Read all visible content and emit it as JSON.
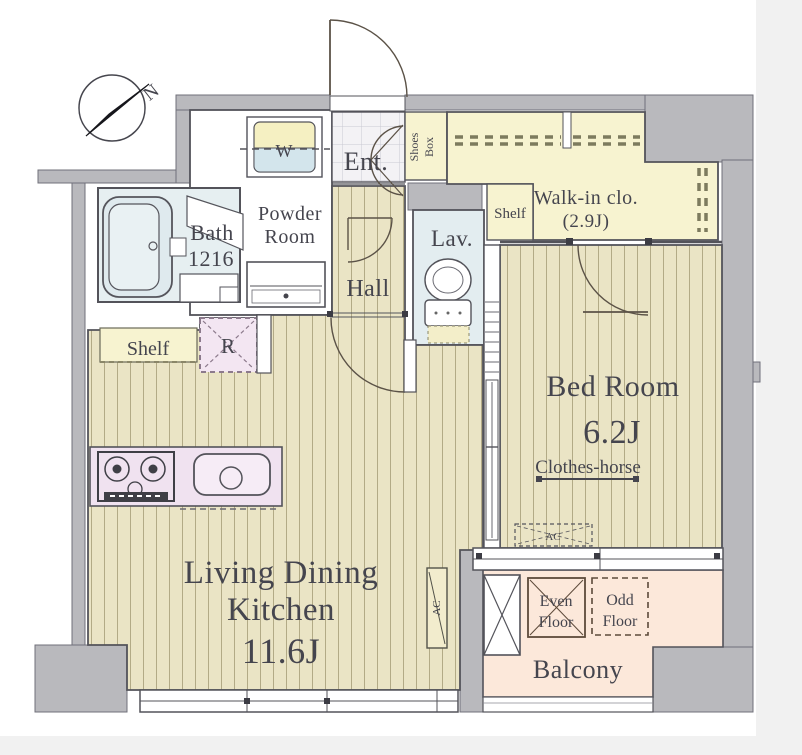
{
  "plan": {
    "compass": {
      "north": "N"
    },
    "entry": {
      "label": "Ent.",
      "shoes_box_line1": "Shoes",
      "shoes_box_line2": "Box"
    },
    "walk_in_closet": {
      "line1": "Walk-in clo.",
      "line2": "(2.9J)",
      "shelf": "Shelf"
    },
    "powder_room": {
      "line1": "Powder",
      "line2": "Room",
      "washer": "W"
    },
    "bath": {
      "line1": "Bath",
      "line2": "1216"
    },
    "hall": {
      "label": "Hall"
    },
    "lavatory": {
      "label": "Lav."
    },
    "bedroom": {
      "name": "Bed Room",
      "size": "6.2J",
      "clothes_horse": "Clothes-horse",
      "ac": "AC"
    },
    "ldk": {
      "line1": "Living Dining",
      "line2": "Kitchen",
      "size": "11.6J",
      "shelf": "Shelf",
      "fridge": "R",
      "ac": "AC"
    },
    "balcony": {
      "label": "Balcony",
      "even_line1": "Even",
      "even_line2": "Floor",
      "odd_line1": "Odd",
      "odd_line2": "Floor"
    }
  }
}
